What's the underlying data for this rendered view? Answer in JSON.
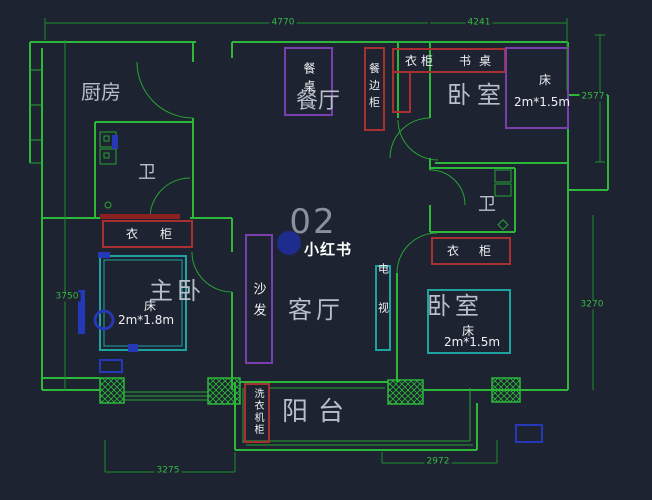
{
  "watermark": {
    "number": "02",
    "brand": "小红书"
  },
  "rooms": {
    "kitchen": "厨房",
    "dining": "餐厅",
    "bedroom_top": "卧室",
    "bath_left": "卫",
    "bath_right": "卫",
    "master": "主卧",
    "living": "客厅",
    "bedroom_bottom": "卧室",
    "balcony": "阳台"
  },
  "furniture": {
    "dining_table": "餐桌",
    "sideboard": "餐边柜",
    "wardrobe_top": "衣柜",
    "desk": "书桌",
    "wardrobe_left": "衣柜",
    "wardrobe_right": "衣柜",
    "sofa": "沙发",
    "tv": "电视",
    "washer_cabinet": "洗衣机柜",
    "bed": "床",
    "bed_master_size": "2m*1.8m",
    "bed_top_size": "2m*1.5m",
    "bed_bottom_size": "2m*1.5m"
  },
  "dimensions": {
    "top_left": "4770",
    "top_right": "4241",
    "right_upper": "2577",
    "right_lower": "3270",
    "left": "3750",
    "bottom_left": "3275",
    "bottom_right": "2972"
  },
  "colors": {
    "background": "#1d2330",
    "wall_green": "#2db83a",
    "thin_green": "#27a334",
    "dim_green": "#1f8c2b",
    "dim_text": "#37b945",
    "furniture_red": "#a83030",
    "furniture_purple": "#7a3fae",
    "furniture_teal": "#1fa3a0",
    "accent_blue": "#2438b8",
    "room_label": "#b9bfc9",
    "furniture_label": "#eef0f4",
    "watermark_grey": "#9097a3"
  }
}
